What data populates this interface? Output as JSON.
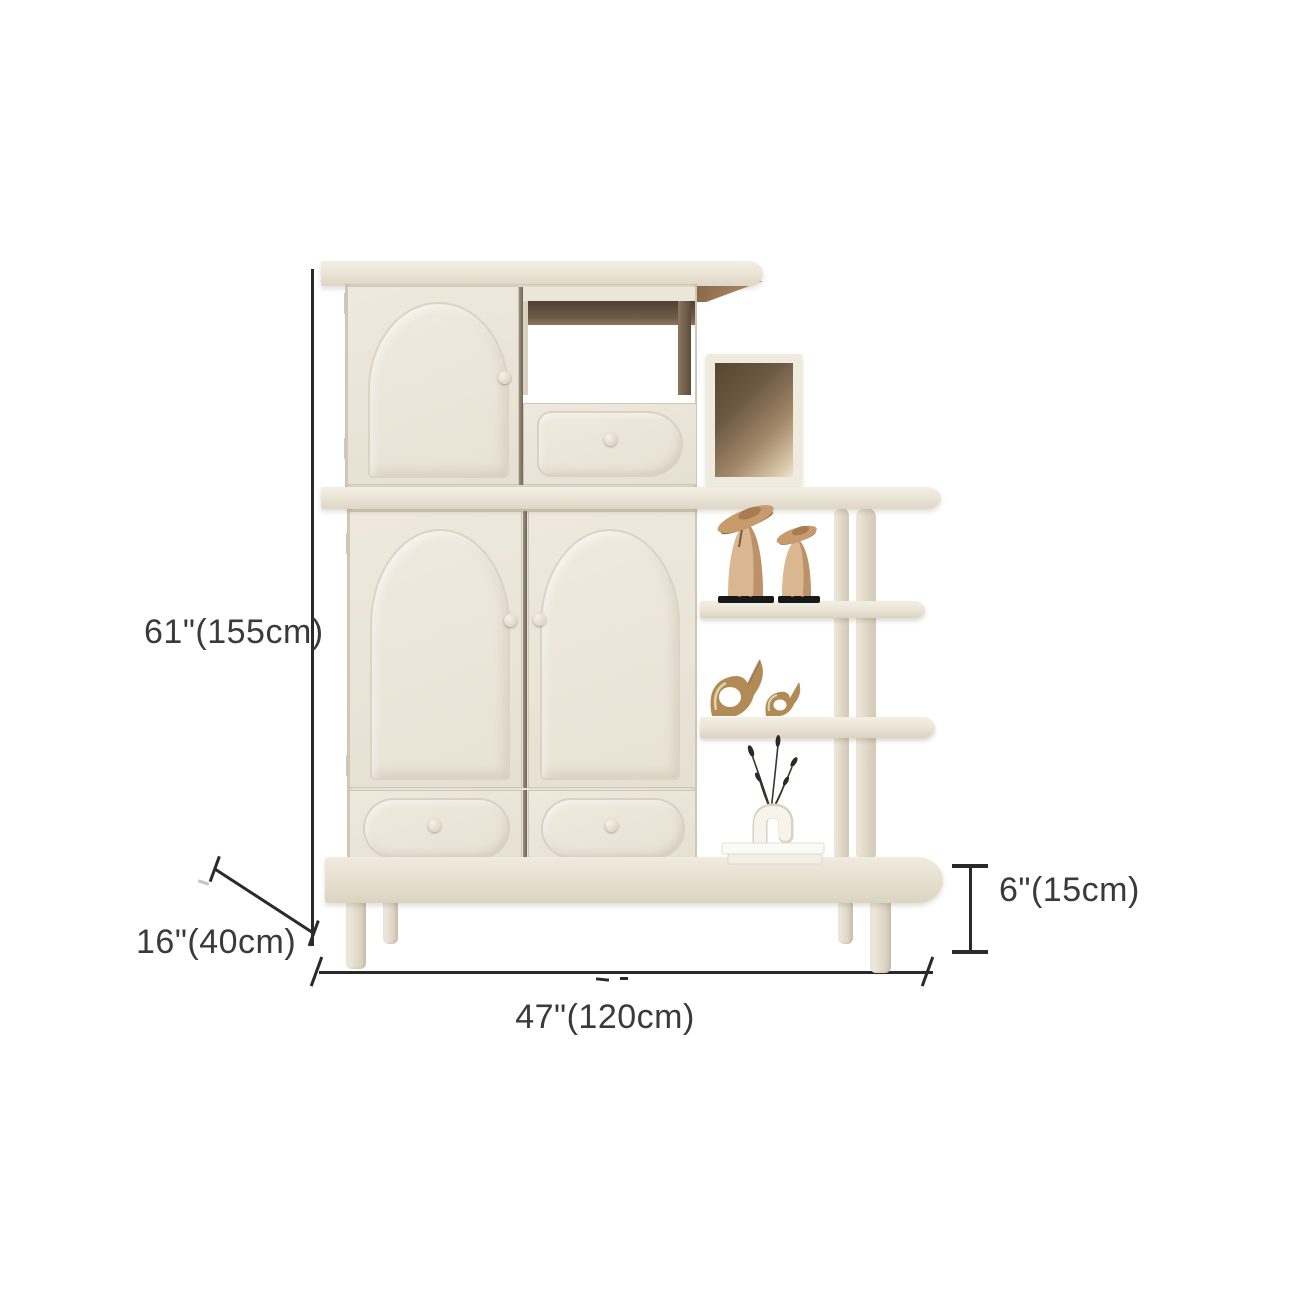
{
  "image": {
    "subject": "cream arched-door display cabinet with tiered side shelves",
    "background_color": "#ffffff"
  },
  "dimensions": {
    "height": "61\"(155cm)",
    "depth": "16\"(40cm)",
    "width": "47\"(120cm)",
    "base_height": "6\"(15cm)"
  },
  "annotation": {
    "line_color": "#2a2a2a",
    "text_color": "#3a3a3a"
  },
  "palette": {
    "cabinet_cream": "#e9e3d6",
    "panel_light": "#efeadf",
    "edge_shadow": "#cfc6b5",
    "wood_underside": "#a8835f",
    "interior_dark": "#5d4b3b",
    "figurine_wood": "#d8b48e",
    "figurine_brass": "#b18a55",
    "figurine_base_black": "#181818",
    "vase_white": "#f7f4ed"
  },
  "decor": [
    {
      "icon": "wooden-bird-figurines-icon",
      "label": "two wooden bird figurines on black bases"
    },
    {
      "icon": "brass-elephant-figurines-icon",
      "label": "two brass elephant figurines"
    },
    {
      "icon": "vase-dried-stems-icon",
      "label": "white u-shaped vase with dried stems on books"
    }
  ]
}
